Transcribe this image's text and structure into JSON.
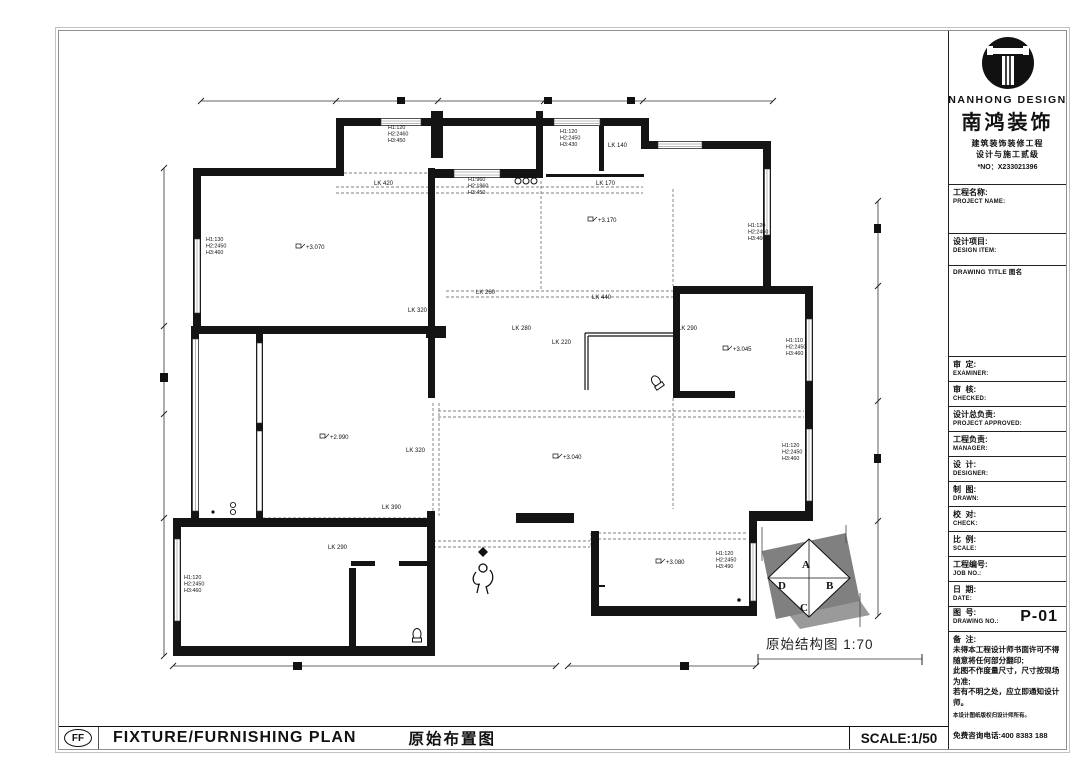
{
  "sheet": {
    "logo": {
      "company_en": "NANHONG DESIGN",
      "company_zh": "南鸿装饰",
      "cert_line1": "建筑装饰装修工程",
      "cert_line2": "设计与施工贰级",
      "cert_no": "*NO：X233021396"
    },
    "title_block": {
      "project_name": {
        "zh": "工程名称:",
        "en": "PROJECT NAME:"
      },
      "design_item": {
        "zh": "设计项目:",
        "en": "DESIGN ITEM:"
      },
      "drawing_title_label": "DRAWING TITLE 图名",
      "fields": [
        {
          "zh": "审  定:",
          "en": "EXAMINER:"
        },
        {
          "zh": "审  核:",
          "en": "CHECKED:"
        },
        {
          "zh": "设计总负责:",
          "en": "PROJECT APPROVED:"
        },
        {
          "zh": "工程负责:",
          "en": "MANAGER:"
        },
        {
          "zh": "设  计:",
          "en": "DESIGNER:"
        },
        {
          "zh": "制  图:",
          "en": "DRAWN:"
        },
        {
          "zh": "校  对:",
          "en": "CHECK:"
        },
        {
          "zh": "比  例:",
          "en": "SCALE:"
        },
        {
          "zh": "工程编号:",
          "en": "JOB NO.:"
        },
        {
          "zh": "日  期:",
          "en": "DATE:"
        }
      ],
      "drawing_no": {
        "zh": "图  号:",
        "en": "DRAWING NO.:",
        "value": "P-01"
      },
      "notes": {
        "title": "备  注:",
        "lines": [
          "未得本工程设计师书面许可不得",
          "随意将任何部分翻印;",
          "此图不作度量尺寸，尺寸按现场",
          "为准;",
          "若有不明之处，应立即通知设计",
          "师。"
        ],
        "fine_print": "本设计图纸版权归设计师所有。",
        "hotline": "免费咨询电话:400 8383 188"
      }
    },
    "footer": {
      "code": "FF",
      "title_en": "FIXTURE/FURNISHING PLAN",
      "title_zh": "原始布置图",
      "scale": "SCALE:1/50"
    },
    "plan": {
      "caption": "原始结构图",
      "caption_scale": "1:70",
      "compass_letters": [
        "A",
        "B",
        "C",
        "D"
      ],
      "labels": [
        {
          "k": "lk",
          "t": "LK 420",
          "x": 218,
          "y": 104
        },
        {
          "k": "lk",
          "t": "LK 170",
          "x": 440,
          "y": 104
        },
        {
          "k": "lk",
          "t": "LK 140",
          "x": 452,
          "y": 66
        },
        {
          "k": "lk",
          "t": "LK 260",
          "x": 320,
          "y": 213
        },
        {
          "k": "lk",
          "t": "LK 440",
          "x": 436,
          "y": 218
        },
        {
          "k": "lk",
          "t": "LK 280",
          "x": 356,
          "y": 249
        },
        {
          "k": "lk",
          "t": "LK 290",
          "x": 522,
          "y": 249
        },
        {
          "k": "lk",
          "t": "LK 220",
          "x": 396,
          "y": 263
        },
        {
          "k": "lk",
          "t": "LK 320",
          "x": 252,
          "y": 231
        },
        {
          "k": "lk",
          "t": "LK 320",
          "x": 250,
          "y": 371
        },
        {
          "k": "lk",
          "t": "LK 390",
          "x": 226,
          "y": 428
        },
        {
          "k": "lk",
          "t": "LK 290",
          "x": 172,
          "y": 468
        },
        {
          "k": "lvl",
          "t": "+3.070",
          "x": 150,
          "y": 168
        },
        {
          "k": "lvl",
          "t": "+3.170",
          "x": 442,
          "y": 141
        },
        {
          "k": "lvl",
          "t": "+2.990",
          "x": 174,
          "y": 358
        },
        {
          "k": "lvl",
          "t": "+3.045",
          "x": 577,
          "y": 270
        },
        {
          "k": "lvl",
          "t": "+3.040",
          "x": 407,
          "y": 378
        },
        {
          "k": "lvl",
          "t": "+3.080",
          "x": 510,
          "y": 483
        },
        {
          "k": "h",
          "t": "H1:120\nH2:2460\nH3:450",
          "x": 232,
          "y": 48
        },
        {
          "k": "h",
          "t": "H1:120\nH2:2450\nH3:430",
          "x": 404,
          "y": 52
        },
        {
          "k": "h",
          "t": "H1:960\nH2:1860\nH3:450",
          "x": 312,
          "y": 100
        },
        {
          "k": "h",
          "t": "H1:130\nH2:2450\nH3:460",
          "x": 50,
          "y": 160
        },
        {
          "k": "h",
          "t": "H1:120\nH2:2450\nH3:460",
          "x": 592,
          "y": 146
        },
        {
          "k": "h",
          "t": "H1:110\nH2:2450\nH3:460",
          "x": 630,
          "y": 261
        },
        {
          "k": "h",
          "t": "H1:120\nH2:2450\nH3:460",
          "x": 626,
          "y": 366
        },
        {
          "k": "h",
          "t": "H1:120\nH2:2450\nH3:490",
          "x": 560,
          "y": 474
        },
        {
          "k": "h",
          "t": "H1:120\nH2:2450\nH3:460",
          "x": 28,
          "y": 498
        },
        {
          "k": "cmp",
          "t": "A",
          "x": 646,
          "y": 487
        },
        {
          "k": "cmp",
          "t": "B",
          "x": 670,
          "y": 508
        },
        {
          "k": "cmp",
          "t": "C",
          "x": 644,
          "y": 530
        },
        {
          "k": "cmp",
          "t": "D",
          "x": 622,
          "y": 508
        },
        {
          "k": "cap",
          "t": "原始结构图  1:70",
          "x": 610,
          "y": 568
        }
      ]
    }
  },
  "colors": {
    "wall": "#141414",
    "sheet_border": "#8f8f8f",
    "compass_gray": "#808080",
    "compass_shadow": "#9a9a9a"
  }
}
